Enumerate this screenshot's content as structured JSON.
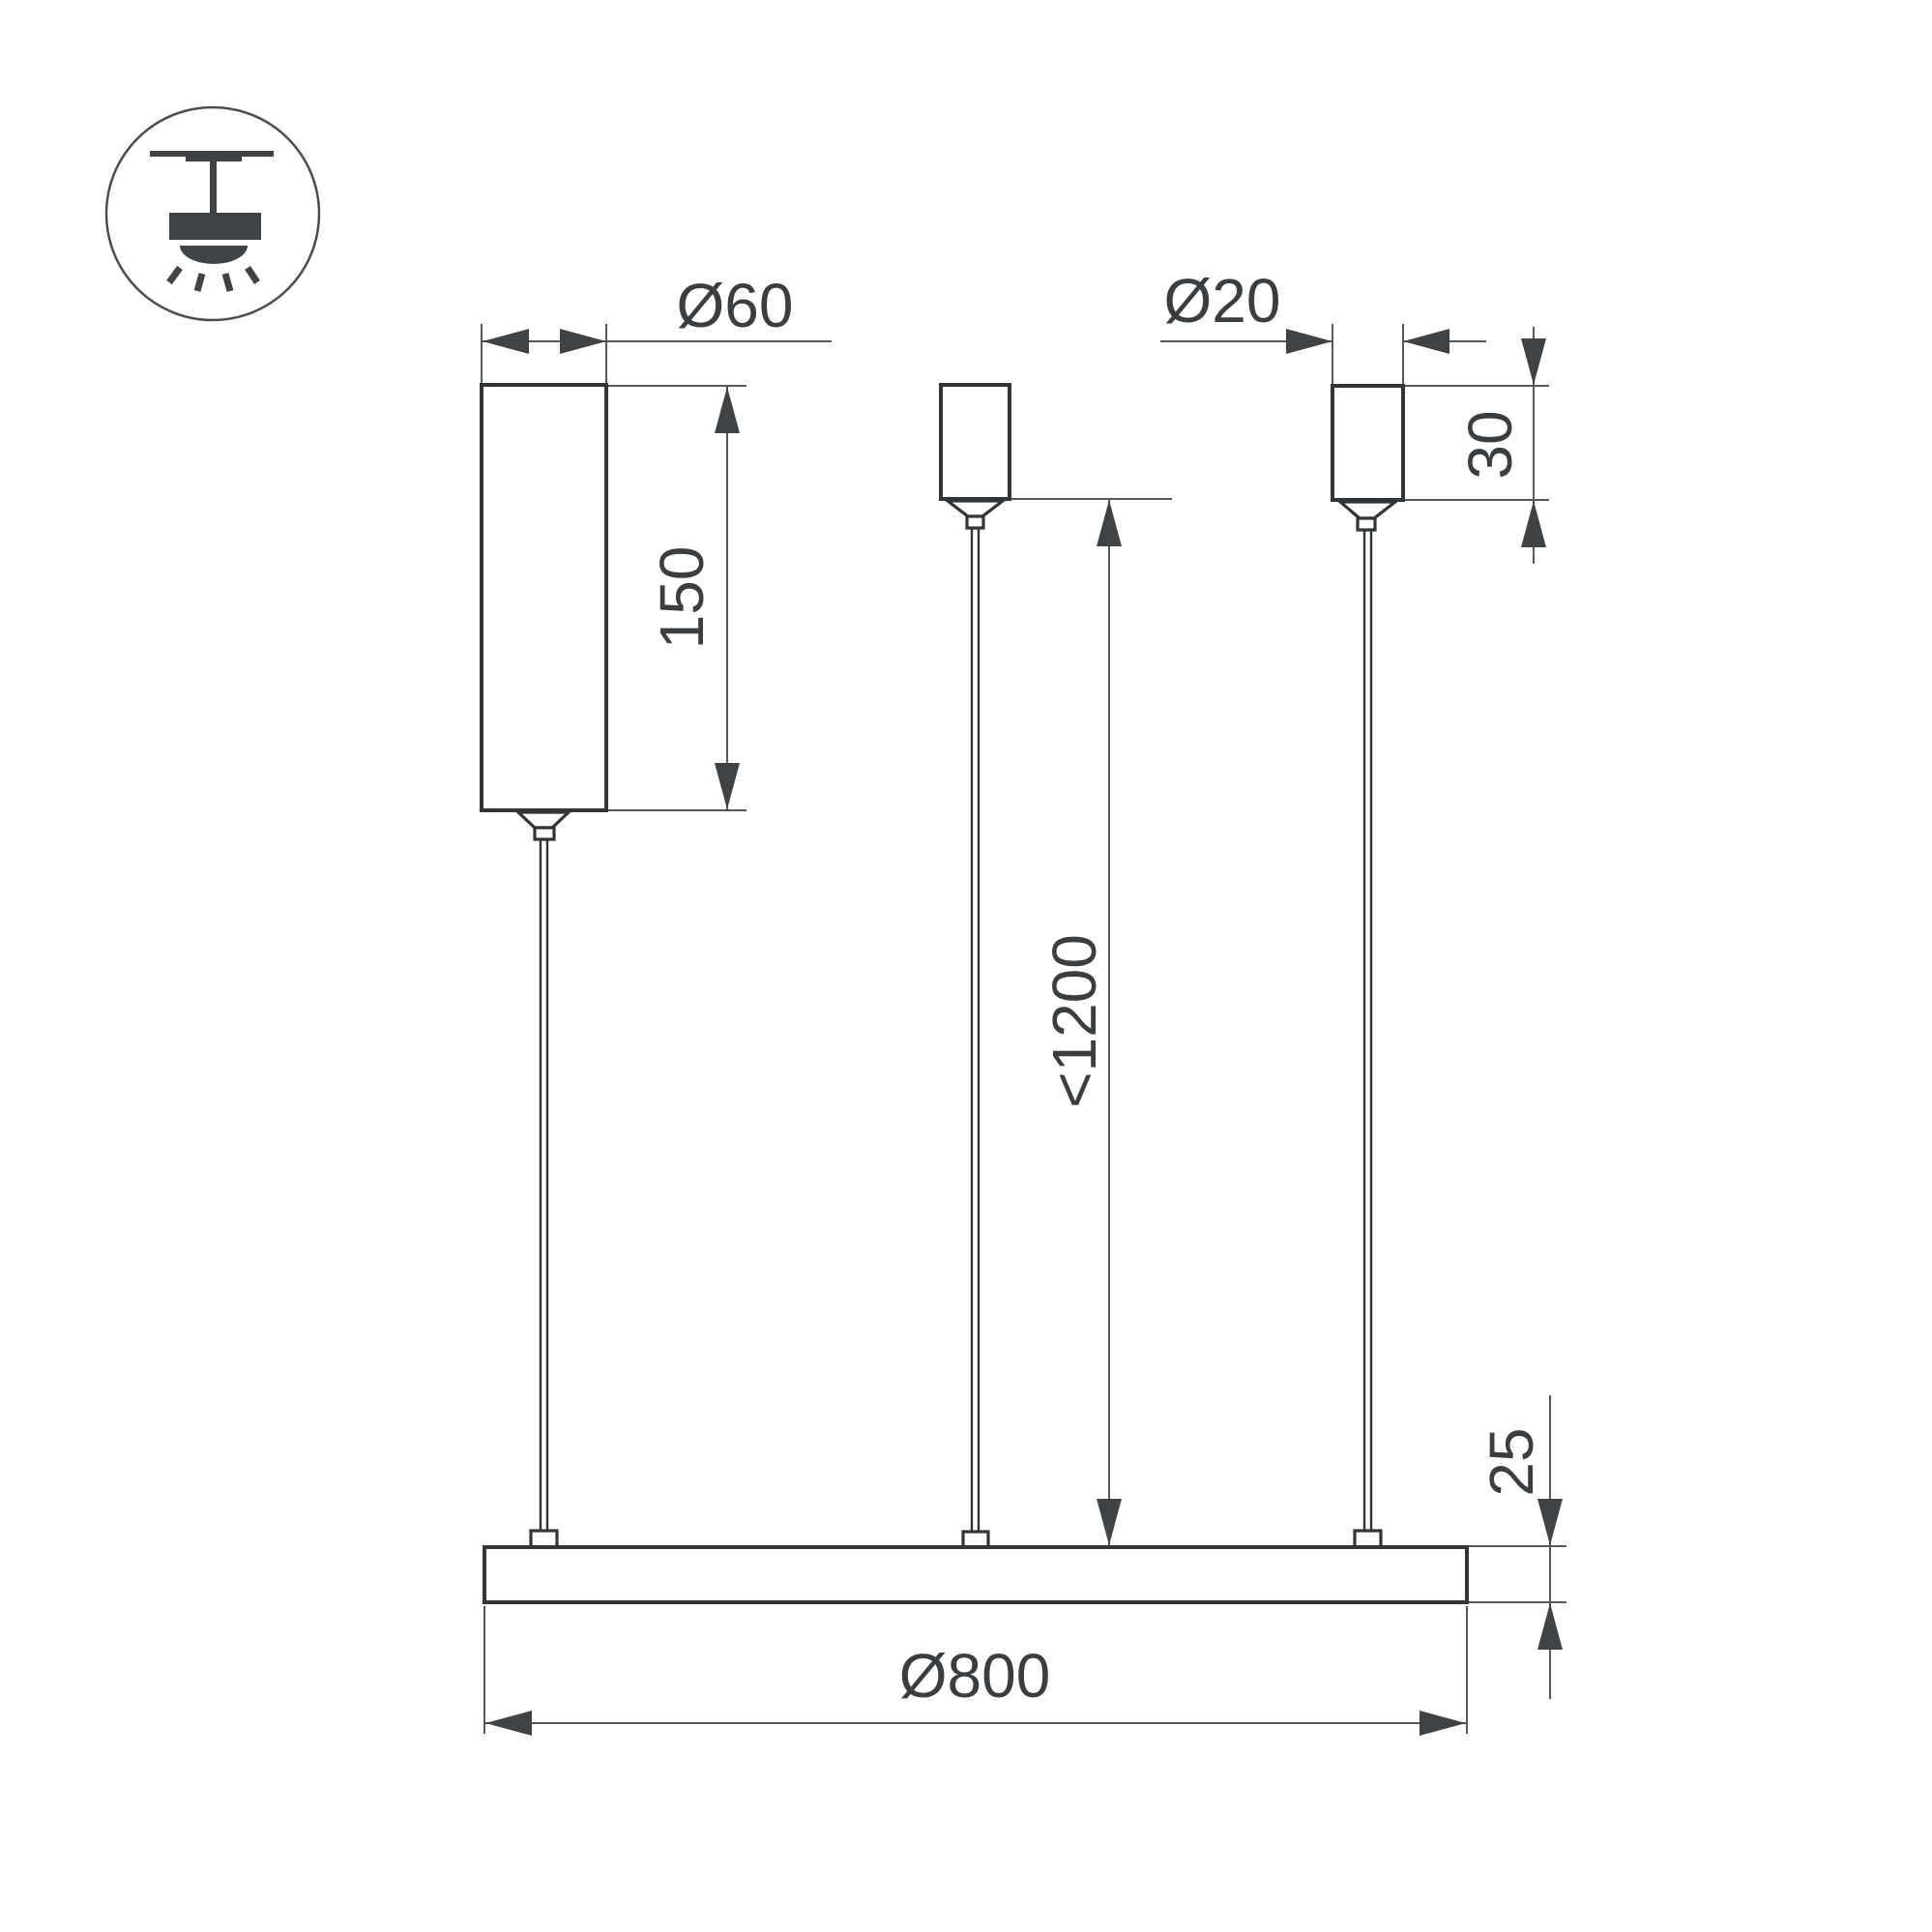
{
  "diagram": {
    "type": "technical-dimension-drawing",
    "subject": "Pendant ring luminaire — side view with suspension dimensions",
    "units": "mm",
    "icon": {
      "name": "pendant-ceiling-light-icon"
    },
    "colors": {
      "background": "#ffffff",
      "object_line": "#313537",
      "dimension_line": "#56595c",
      "arrow_fill": "#3f4346",
      "text": "#3a3e41"
    },
    "labels": {
      "canopy_diameter": "Ø60",
      "canopy_height": "150",
      "grip_diameter": "Ø20",
      "grip_height": "30",
      "max_suspension": "<1200",
      "profile_thickness": "25",
      "ring_diameter": "Ø800"
    }
  }
}
